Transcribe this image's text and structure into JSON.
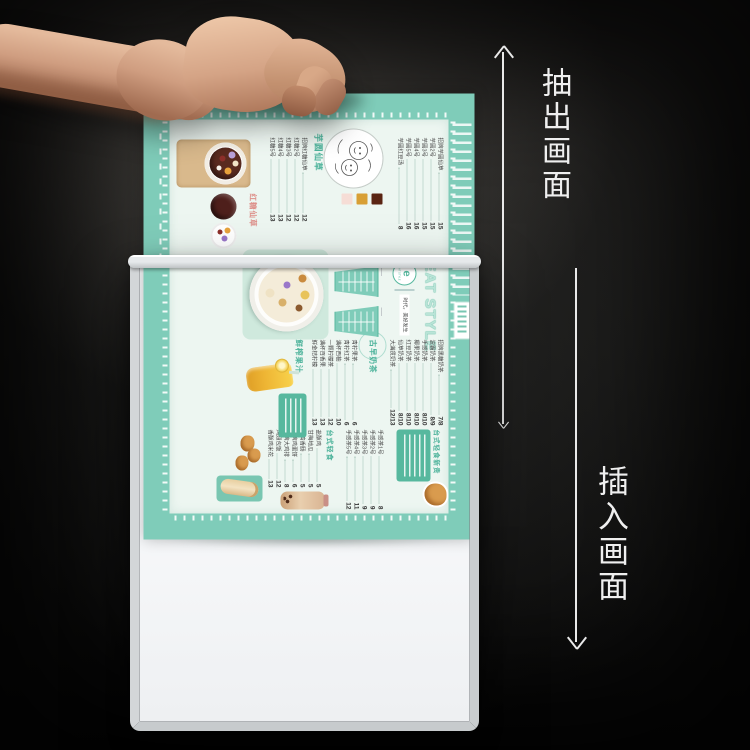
{
  "annotations": {
    "pull_out": {
      "label": "抽出画面",
      "direction": "up"
    },
    "insert": {
      "label": "插入画面",
      "direction": "down"
    }
  },
  "poster": {
    "brand": "EAT STYLE",
    "logo_letter": "e",
    "logo_caption": "EAT STYLE",
    "slogan": "时代，美好发生",
    "new_tag": "台式轻食新贵",
    "sections": [
      {
        "title": "芋圆仙草",
        "items": [
          {
            "name": "招牌芋圆仙草",
            "price": "15"
          },
          {
            "name": "芋圆2号",
            "price": "15"
          },
          {
            "name": "芋圆3号",
            "price": "15"
          },
          {
            "name": "芋圆4号",
            "price": "16"
          },
          {
            "name": "芋圆5号",
            "price": "16"
          },
          {
            "name": "芋圆红豆汤",
            "price": "8"
          }
        ]
      },
      {
        "title": "红糖仙草",
        "items": [
          {
            "name": "招牌红糖仙草",
            "price": "12"
          },
          {
            "name": "红糖2号",
            "price": "12"
          },
          {
            "name": "红糖3号",
            "price": "12"
          },
          {
            "name": "红糖4号",
            "price": "13"
          },
          {
            "name": "红糖5号",
            "price": "13"
          }
        ]
      },
      {
        "title": "古早奶茶",
        "items": [
          {
            "name": "招牌黑糖奶茶",
            "price": "7/8"
          },
          {
            "name": "波霸奶茶",
            "price": "8/9"
          },
          {
            "name": "手感奶茶",
            "price": "8/10"
          },
          {
            "name": "椰果奶茶",
            "price": "8/10"
          },
          {
            "name": "红豆奶茶",
            "price": "8/10"
          },
          {
            "name": "仙草奶茶",
            "price": "8/10"
          },
          {
            "name": "大满贯奶茶",
            "price": "12/13"
          }
        ]
      },
      {
        "title": "鲜榨果汁",
        "items": [
          {
            "name": "青柠果茶",
            "price": "6"
          },
          {
            "name": "青柠红茶",
            "price": "6"
          },
          {
            "name": "满杯西柚",
            "price": "10"
          },
          {
            "name": "一颗柠檬茶",
            "price": "12"
          },
          {
            "name": "满杯百香果",
            "price": "13"
          },
          {
            "name": "鲜金桔柠檬",
            "price": "13"
          }
        ]
      },
      {
        "title": "台式轻食",
        "items": [
          {
            "name": "盐酥鸡",
            "price": "5"
          },
          {
            "name": "甘梅地瓜",
            "price": "5"
          },
          {
            "name": "台湾香肠",
            "price": "5"
          },
          {
            "name": "招牌鸡蛋饼",
            "price": "6"
          },
          {
            "name": "招牌大鸡排",
            "price": "8"
          },
          {
            "name": "鸡翅包饭",
            "price": "12"
          },
          {
            "name": "香酥鸡米花",
            "price": "13"
          }
        ]
      },
      {
        "title": "手感茶",
        "items": [
          {
            "name": "手感茶1号",
            "price": "8"
          },
          {
            "name": "手感茶2号",
            "price": "9"
          },
          {
            "name": "手感茶3号",
            "price": "9"
          },
          {
            "name": "手感茶4号",
            "price": "11"
          },
          {
            "name": "手感茶5号",
            "price": "12"
          }
        ]
      }
    ]
  },
  "colors": {
    "teal": "#7fccb9",
    "teal_deep": "#57b89e",
    "panel": "#edf6f1",
    "frame_face": "#d6d9db",
    "backing": "#f8fafc",
    "skin": "#cf9d80",
    "background": "#141413",
    "annotation_text": "#efefef",
    "swatches": [
      "#5a2413",
      "#d89f35",
      "#f6ddd6"
    ]
  }
}
